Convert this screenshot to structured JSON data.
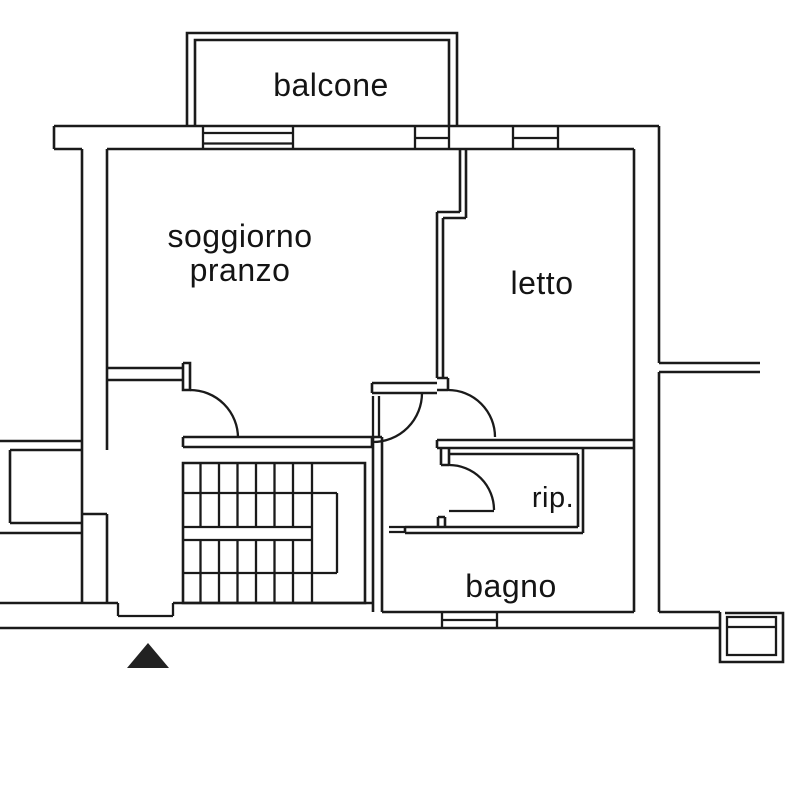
{
  "type": "floor-plan",
  "language": "it",
  "rooms": {
    "balcony": "balcone",
    "living_line1": "soggiorno",
    "living_line2": "pranzo",
    "bedroom": "letto",
    "storage": "rip.",
    "bathroom": "bagno"
  },
  "colors": {
    "line": "#1a1a1a",
    "background": "#ffffff",
    "entrance_marker": "#222222"
  }
}
